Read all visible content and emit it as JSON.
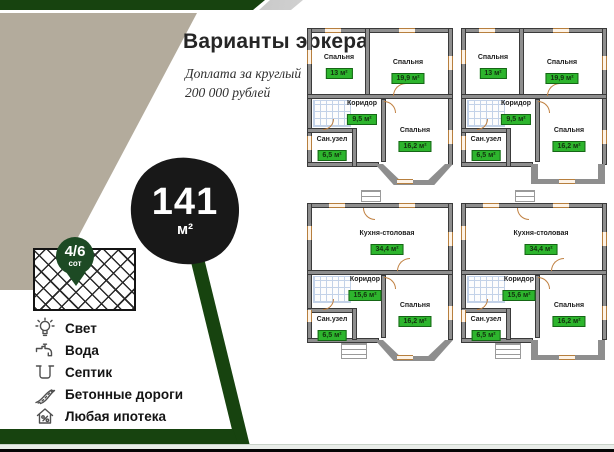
{
  "header": {
    "title": "Варианты эркера",
    "subtitle_line1": "Доплата за круглый",
    "subtitle_line2": "200 000 рублей"
  },
  "badge": {
    "value": "141",
    "unit": "м²"
  },
  "plot_pin": {
    "value": "4/6",
    "unit": "сот"
  },
  "amenities": {
    "items": [
      {
        "icon": "lightbulb-icon",
        "label": "Свет"
      },
      {
        "icon": "faucet-icon",
        "label": "Вода"
      },
      {
        "icon": "septic-icon",
        "label": "Септик"
      },
      {
        "icon": "road-icon",
        "label": "Бетонные дороги"
      },
      {
        "icon": "mortgage-icon",
        "label": "Любая ипотека"
      }
    ]
  },
  "plans": [
    {
      "rooms": [
        {
          "name": "Спальня",
          "area": "13 м²"
        },
        {
          "name": "Спальня",
          "area": "19,9 м²"
        },
        {
          "name": "Коридор",
          "area": "9,5 м²"
        },
        {
          "name": "Сан.узел",
          "area": "6,5 м²"
        },
        {
          "name": "Спальня",
          "area": "16,2 м²"
        }
      ]
    },
    {
      "rooms": [
        {
          "name": "Спальня",
          "area": "13 м²"
        },
        {
          "name": "Спальня",
          "area": "19,9 м²"
        },
        {
          "name": "Коридор",
          "area": "9,5 м²"
        },
        {
          "name": "Сан.узел",
          "area": "6,5 м²"
        },
        {
          "name": "Спальня",
          "area": "16,2 м²"
        }
      ]
    },
    {
      "rooms": [
        {
          "name": "Кухня-столовая",
          "area": "34,4 м²"
        },
        {
          "name": "Коридор",
          "area": "15,6 м²"
        },
        {
          "name": "Сан.узел",
          "area": "6,5 м²"
        },
        {
          "name": "Спальня",
          "area": "16,2 м²"
        }
      ]
    },
    {
      "rooms": [
        {
          "name": "Кухня-столовая",
          "area": "34,4 м²"
        },
        {
          "name": "Коридор",
          "area": "15,6 м²"
        },
        {
          "name": "Сан.узел",
          "area": "6,5 м²"
        },
        {
          "name": "Спальня",
          "area": "16,2 м²"
        }
      ]
    }
  ],
  "colors": {
    "accent_green": "#17430f",
    "pin_green": "#1d4a24",
    "label_green": "#2db52d",
    "badge_black": "#181818"
  }
}
